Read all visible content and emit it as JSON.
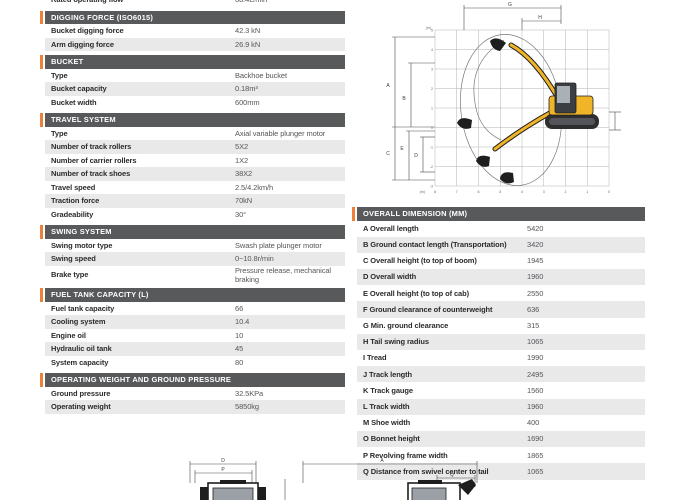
{
  "colors": {
    "accent": "#ee8137",
    "header_bg": "#58595b",
    "row_alt": "#e9e9ea",
    "machine_yellow": "#f0b428",
    "machine_dark": "#2e2e2e"
  },
  "spec_table": {
    "partial_row": {
      "label": "Rated operating flow",
      "value": "68.4L/min"
    },
    "sections": [
      {
        "header": "DIGGING FORCE (ISO6015)",
        "rows": [
          [
            "Bucket digging force",
            "42.3 kN"
          ],
          [
            "Arm digging force",
            "26.9 kN"
          ]
        ]
      },
      {
        "header": "BUCKET",
        "rows": [
          [
            "Type",
            "Backhoe bucket"
          ],
          [
            "Bucket capacity",
            "0.18m³"
          ],
          [
            "Bucket width",
            "600mm"
          ]
        ]
      },
      {
        "header": "TRAVEL SYSTEM",
        "rows": [
          [
            "Type",
            "Axial variable plunger motor"
          ],
          [
            "Number of track rollers",
            "5X2"
          ],
          [
            "Number of carrier rollers",
            "1X2"
          ],
          [
            "Number of track shoes",
            "38X2"
          ],
          [
            "Travel speed",
            "2.5/4.2km/h"
          ],
          [
            "Traction force",
            "70kN"
          ],
          [
            "Gradeability",
            "30°"
          ]
        ]
      },
      {
        "header": "SWING SYSTEM",
        "rows": [
          [
            "Swing motor type",
            "Swash plate plunger motor"
          ],
          [
            "Swing speed",
            "0~10.8r/min"
          ],
          [
            "Brake type",
            "Pressure release, mechanical braking"
          ]
        ]
      },
      {
        "header": "FUEL TANK CAPACITY (L)",
        "rows": [
          [
            "Fuel tank capacity",
            "66"
          ],
          [
            "Cooling system",
            "10.4"
          ],
          [
            "Engine oil",
            "10"
          ],
          [
            "Hydraulic oil tank",
            "45"
          ],
          [
            "System capacity",
            "80"
          ]
        ]
      },
      {
        "header": "OPERATING WEIGHT AND GROUND PRESSURE",
        "rows": [
          [
            "Ground pressure",
            "32.5KPa"
          ],
          [
            "Operating weight",
            "5850kg"
          ]
        ]
      }
    ]
  },
  "dimension_table": {
    "header": "OVERALL DIMENSION (MM)",
    "rows": [
      [
        "A Overall length",
        "5420"
      ],
      [
        "B Ground contact length (Transportation)",
        "3420"
      ],
      [
        "C Overall height (to top of boom)",
        "1945"
      ],
      [
        "D Overall width",
        "1960"
      ],
      [
        "E Overall height (to top of cab)",
        "2550"
      ],
      [
        "F Ground clearance of counterweight",
        "636"
      ],
      [
        "G Min. ground clearance",
        "315"
      ],
      [
        "H Tail swing radius",
        "1065"
      ],
      [
        "I Tread",
        "1990"
      ],
      [
        "J Track length",
        "2495"
      ],
      [
        "K Track gauge",
        "1560"
      ],
      [
        "L Track width",
        "1960"
      ],
      [
        "M Shoe width",
        "400"
      ],
      [
        "O Bonnet height",
        "1690"
      ],
      [
        "P Revolving frame width",
        "1865"
      ],
      [
        "Q Distance from swivel center to tail",
        "1065"
      ]
    ]
  },
  "range_diagram": {
    "top_labels": {
      "g": "G",
      "h": "H"
    },
    "left_labels": {
      "a": "A",
      "b": "B",
      "c": "C",
      "e": "E",
      "d": "D"
    },
    "x_axis": [
      "8",
      "7",
      "6",
      "5",
      "4",
      "3",
      "2",
      "1",
      "0"
    ],
    "y_axis": [
      "5",
      "4",
      "3",
      "2",
      "1",
      "0",
      "-1",
      "-2",
      "-3"
    ],
    "unit": "(m)"
  },
  "front_diagram": {
    "labels": {
      "d": "D",
      "p": "P"
    }
  },
  "side_diagram": {
    "labels": {
      "a": "A",
      "q": "Q"
    }
  }
}
